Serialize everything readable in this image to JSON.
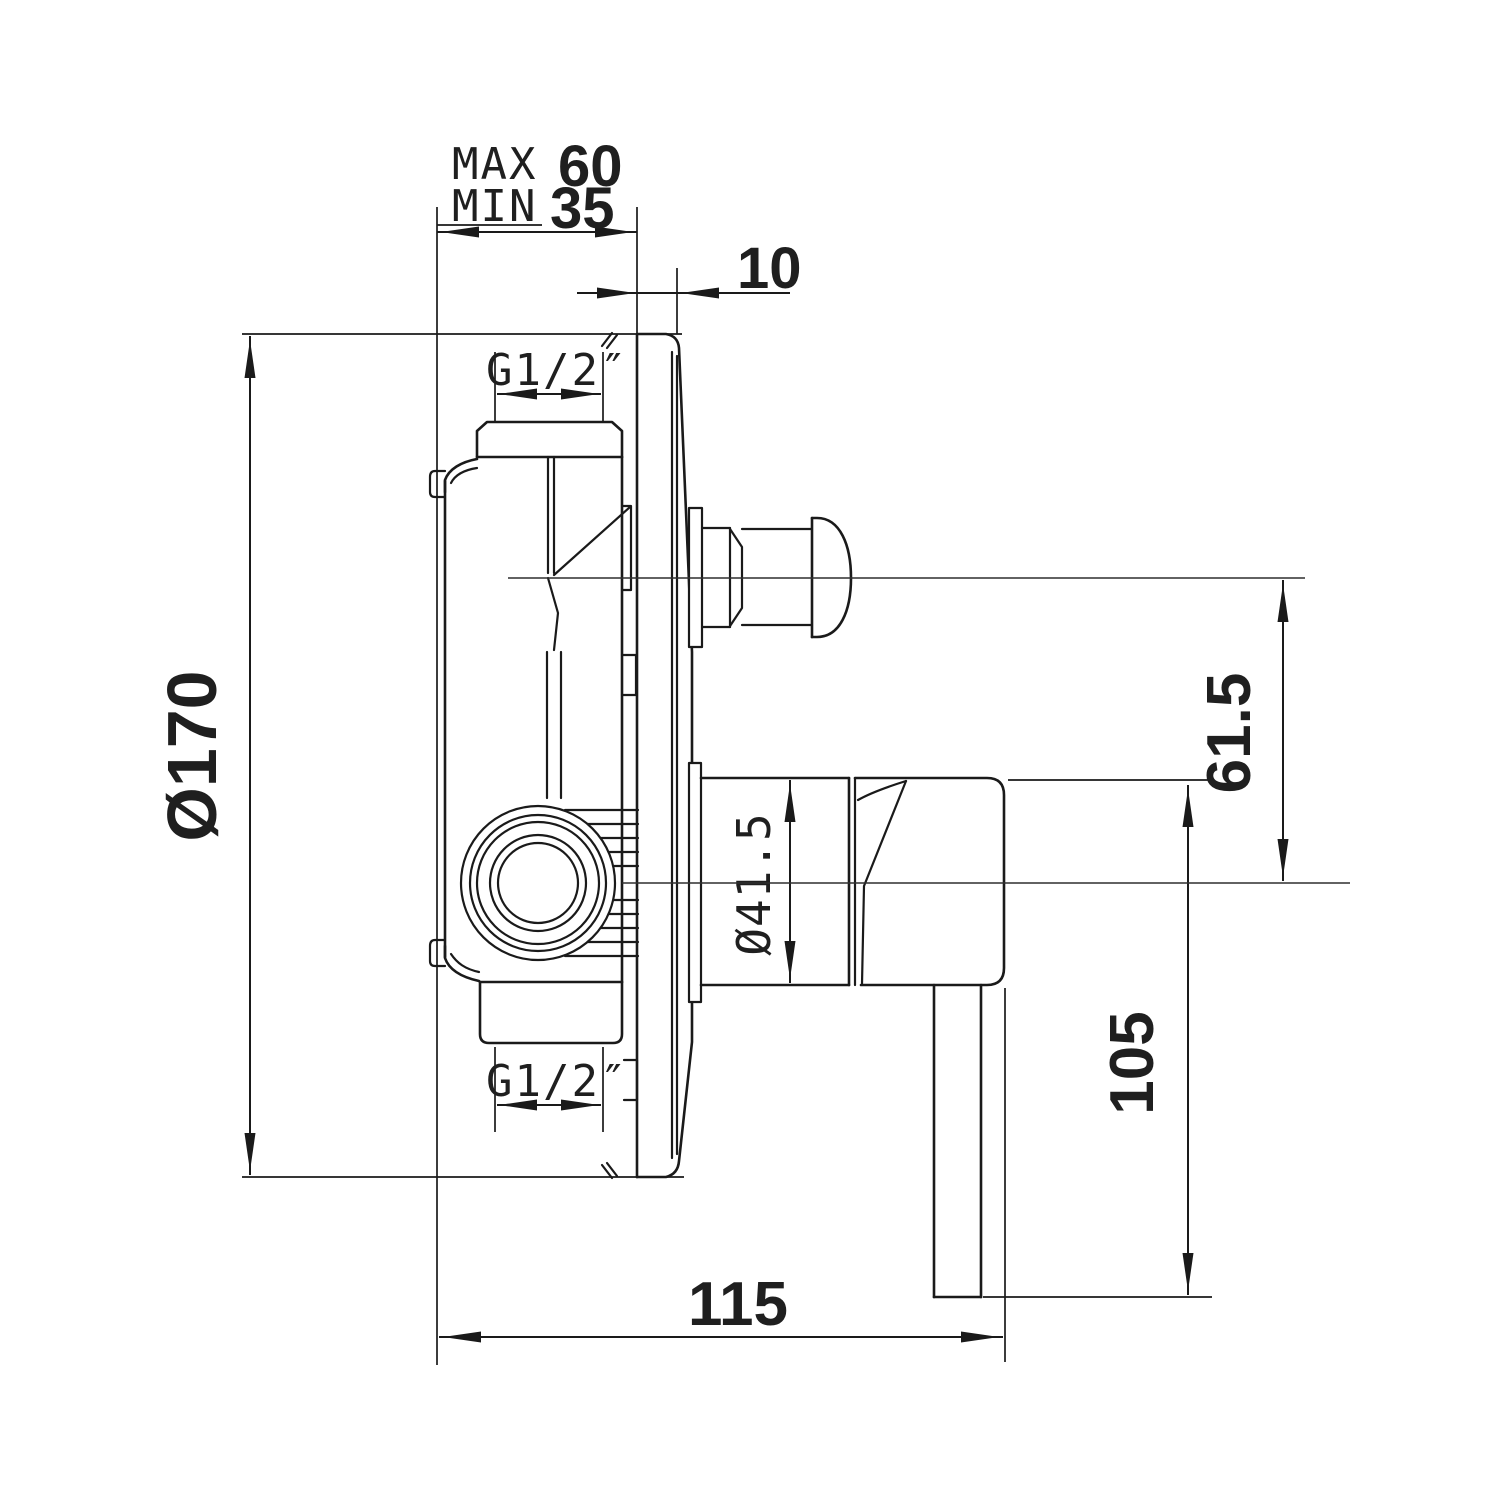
{
  "drawing": {
    "type": "technical-dimension-drawing",
    "subject": "concealed-shower-mixer-valve-side-section",
    "dimensions": {
      "depth_max_label": "MAX",
      "depth_max_value": "60",
      "depth_min_label": "MIN",
      "depth_min_value": "35",
      "plate_offset_value": "10",
      "top_thread_label": "G1/2″",
      "plate_diameter_label": "Ø170",
      "sleeve_diameter_label": "Ø41.5",
      "diverter_height_value": "61.5",
      "handle_length_value": "105",
      "projection_value": "115",
      "bottom_thread_label": "G1/2″"
    },
    "colors": {
      "line": "#1a1a1a",
      "background": "#ffffff"
    }
  }
}
